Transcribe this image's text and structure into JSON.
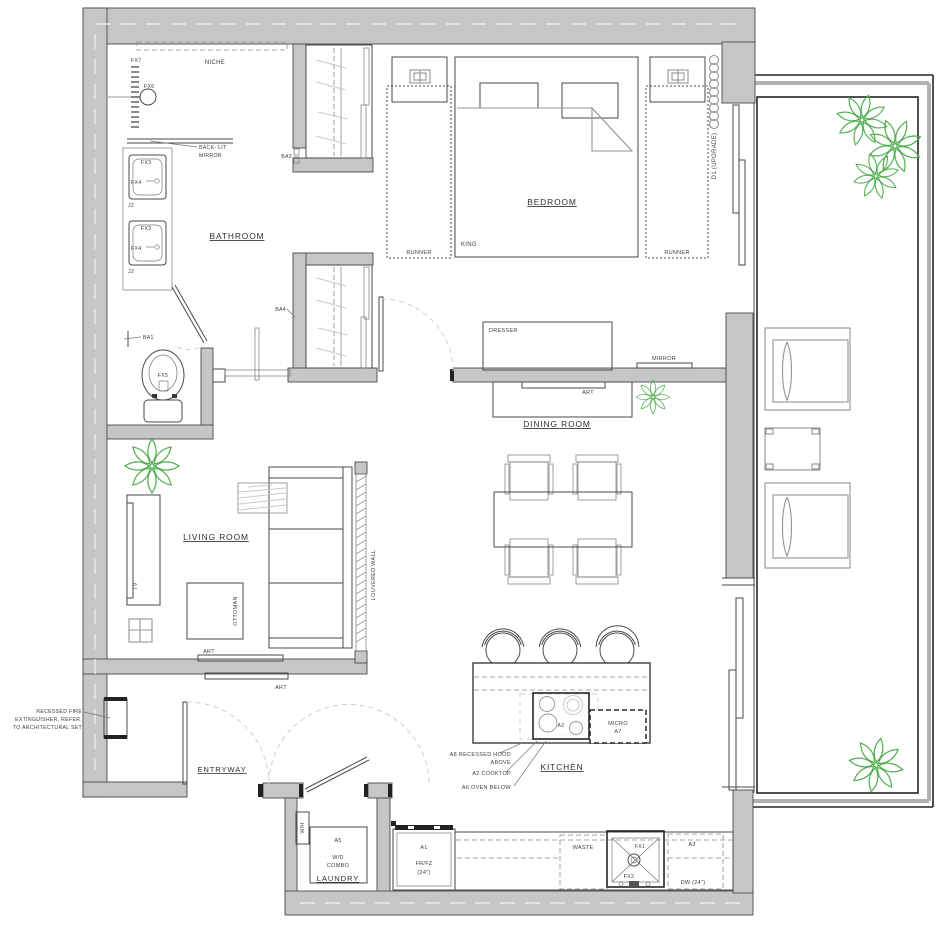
{
  "colors": {
    "wall": "#c6c6c6",
    "wall_edge": "#4a4a4a",
    "line": "#4a4a4a",
    "plant": "#4fae4f"
  },
  "rooms": {
    "bathroom": "BATHROOM",
    "bedroom": "BEDROOM",
    "dining_room": "DINING ROOM",
    "living_room": "LIVING ROOM",
    "kitchen": "KITCHEN",
    "entryway": "ENTRYWAY",
    "laundry": "LAUNDRY"
  },
  "bathroom": {
    "niche": "NICHE",
    "fx7": "FX7",
    "fx6": "FX6",
    "backlit_line1": "BACK- LIT",
    "backlit_line2": "MIRROR",
    "fx3": "FX3",
    "fx4": "FX4",
    "j2": "J2",
    "fx5": "FX5",
    "ba1": "BA1",
    "ba3": "BA3",
    "ba4": "BA4"
  },
  "bedroom": {
    "king": "KING",
    "runner": "RUNNER",
    "d1_upgrade": "D1 (UPGRADE)",
    "dresser": "DRESSER",
    "mirror": "MIRROR"
  },
  "dining": {
    "art": "ART"
  },
  "living": {
    "tv": "TV",
    "ottoman": "OTTOMAN",
    "art": "ART",
    "louvered_wall": "LOUVERED WALL"
  },
  "entry": {
    "fire_note_line1": "RECESSED FIRE",
    "fire_note_line2": "EXTINGUISHER, REFER.",
    "fire_note_line3": "TO ARCHITECTURAL SET"
  },
  "laundry": {
    "wh": "W/H",
    "a5": "A5",
    "wd": "W/D",
    "combo": "COMBO"
  },
  "kitchen": {
    "hood_note_line1": "A8 RECESSED HOOD",
    "hood_note_line2": "ABOVE",
    "cooktop_note": "A2 COOKTOP",
    "oven_note": "A6 OVEN BELOW",
    "a2": "A2",
    "micro": "MICRO",
    "a7": "A7",
    "a1": "A1",
    "fridge": "FR/FZ",
    "size_24": "(24\")",
    "waste": "WASTE",
    "fx1": "FX1",
    "fx2": "FX2",
    "a3": "A3",
    "dw": "DW (24\")"
  }
}
